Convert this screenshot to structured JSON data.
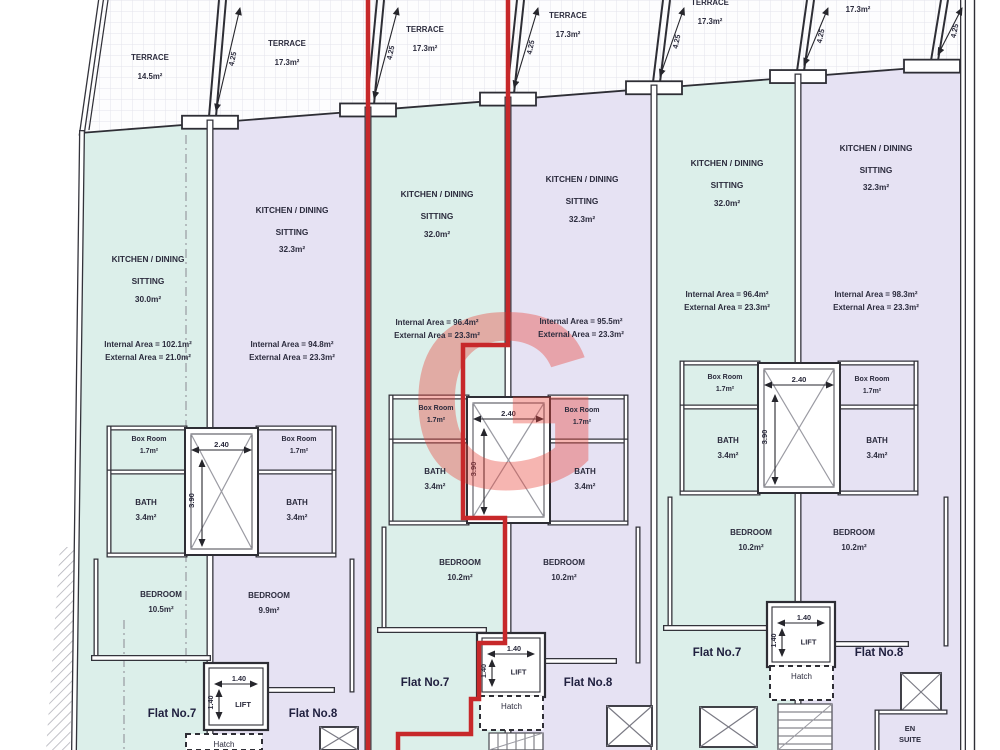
{
  "watermark": {
    "letter": "G",
    "color": "#e9463c"
  },
  "labels": {
    "lift": "LIFT",
    "hatch": "Hatch",
    "en_suite1": "EN",
    "en_suite2": "SUITE"
  },
  "dims": {
    "terrace_depth": "4.25",
    "shaft_width": "2.40",
    "shaft_height": "3.90",
    "lift_width": "1.40",
    "lift_height": "1.40"
  },
  "terraces": [
    {
      "name": "TERRACE",
      "area": "14.5m²"
    },
    {
      "name": "TERRACE",
      "area": "17.3m²"
    },
    {
      "name": "TERRACE",
      "area": "17.3m²"
    },
    {
      "name": "TERRACE",
      "area": "17.3m²"
    },
    {
      "name": "TERRACE",
      "area": "17.3m²"
    },
    {
      "name": "TERRACE",
      "area": "17.3m²"
    }
  ],
  "blocks": [
    {
      "flat7": {
        "room": "KITCHEN / DINING",
        "room2": "SITTING",
        "room_area": "30.0m²",
        "internal": "Internal Area = 102.1m²",
        "external": "External Area = 21.0m²",
        "box_room": "Box Room",
        "box_room_area": "1.7m²",
        "bath": "BATH",
        "bath_area": "3.4m²",
        "bedroom": "BEDROOM",
        "bedroom_area": "10.5m²",
        "flat_no": "Flat No.7"
      },
      "flat8": {
        "room": "KITCHEN / DINING",
        "room2": "SITTING",
        "room_area": "32.3m²",
        "internal": "Internal Area = 94.8m²",
        "external": "External Area = 23.3m²",
        "box_room": "Box Room",
        "box_room_area": "1.7m²",
        "bath": "BATH",
        "bath_area": "3.4m²",
        "bedroom": "BEDROOM",
        "bedroom_area": "9.9m²",
        "flat_no": "Flat No.8"
      }
    },
    {
      "flat7": {
        "room": "KITCHEN / DINING",
        "room2": "SITTING",
        "room_area": "32.0m²",
        "internal": "Internal Area = 96.4m²",
        "external": "External Area = 23.3m²",
        "box_room": "Box Room",
        "box_room_area": "1.7m²",
        "bath": "BATH",
        "bath_area": "3.4m²",
        "bedroom": "BEDROOM",
        "bedroom_area": "10.2m²",
        "flat_no": "Flat No.7"
      },
      "flat8": {
        "room": "KITCHEN / DINING",
        "room2": "SITTING",
        "room_area": "32.3m²",
        "internal": "Internal Area = 95.5m²",
        "external": "External Area = 23.3m²",
        "box_room": "Box Room",
        "box_room_area": "1.7m²",
        "bath": "BATH",
        "bath_area": "3.4m²",
        "bedroom": "BEDROOM",
        "bedroom_area": "10.2m²",
        "flat_no": "Flat No.8"
      }
    },
    {
      "flat7": {
        "room": "KITCHEN / DINING",
        "room2": "SITTING",
        "room_area": "32.0m²",
        "internal": "Internal Area = 96.4m²",
        "external": "External Area = 23.3m²",
        "box_room": "Box Room",
        "box_room_area": "1.7m²",
        "bath": "BATH",
        "bath_area": "3.4m²",
        "bedroom": "BEDROOM",
        "bedroom_area": "10.2m²",
        "flat_no": "Flat No.7"
      },
      "flat8": {
        "room": "KITCHEN / DINING",
        "room2": "SITTING",
        "room_area": "32.3m²",
        "internal": "Internal Area = 98.3m²",
        "external": "External Area = 23.3m²",
        "box_room": "Box Room",
        "box_room_area": "1.7m²",
        "bath": "BATH",
        "bath_area": "3.4m²",
        "bedroom": "BEDROOM",
        "bedroom_area": "10.2m²",
        "flat_no": "Flat No.8"
      }
    }
  ]
}
